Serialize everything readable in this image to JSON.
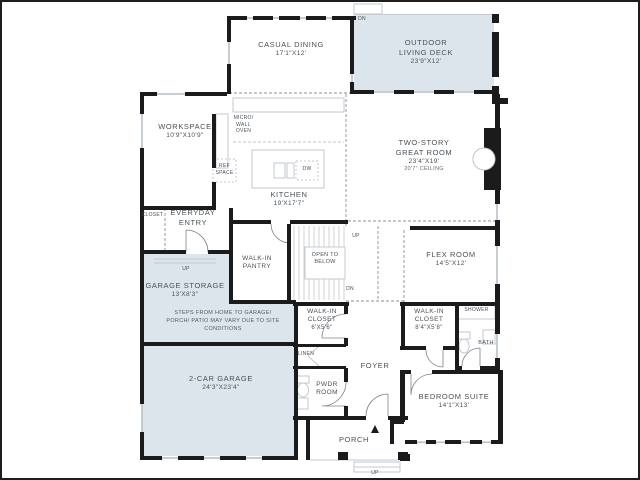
{
  "meta": {
    "shade_color": "#dce4ec",
    "wall_color": "#1b1b1b",
    "text_color": "#4b5156"
  },
  "rooms": {
    "casual_dining": {
      "name": "CASUAL DINING",
      "dims": "17'1\"X12'"
    },
    "outdoor_deck": {
      "name": "OUTDOOR LIVING DECK",
      "dims": "23'9\"X12'"
    },
    "workspace": {
      "name": "WORKSPACE",
      "dims": "10'9\"X10'9\""
    },
    "great_room": {
      "name": "TWO-STORY GREAT ROOM",
      "dims": "23'4\"X19'",
      "ceiling": "20'7\" CEILING"
    },
    "kitchen": {
      "name": "KITCHEN",
      "dims": "19'X17'7\""
    },
    "everyday_entry": {
      "name": "EVERYDAY ENTRY"
    },
    "closet": {
      "name": "CLOSET"
    },
    "walk_in_pantry": {
      "name": "WALK-IN PANTRY"
    },
    "open_to_below": {
      "name": "OPEN TO BELOW"
    },
    "flex_room": {
      "name": "FLEX ROOM",
      "dims": "14'5\"X12'"
    },
    "garage_storage": {
      "name": "GARAGE STORAGE",
      "dims": "13'X8'3\""
    },
    "garage_note": "STEPS FROM HOME TO GARAGE/ PORCH/ PATIO MAY VARY DUE TO SITE CONDITIONS",
    "walk_in_closet_a": {
      "name": "WALK-IN CLOSET",
      "dims": "6'X5'6\""
    },
    "walk_in_closet_b": {
      "name": "WALK-IN CLOSET",
      "dims": "8'4\"X5'8\""
    },
    "linen": {
      "name": "LINEN"
    },
    "pwdr_room": {
      "name": "PWDR ROOM"
    },
    "foyer": {
      "name": "FOYER"
    },
    "shower": {
      "name": "SHOWER"
    },
    "bath": {
      "name": "BATH"
    },
    "two_car_garage": {
      "name": "2-CAR GARAGE",
      "dims": "24'3\"X23'4\""
    },
    "bedroom_suite": {
      "name": "BEDROOM SUITE",
      "dims": "14'1\"X13'"
    },
    "porch": {
      "name": "PORCH"
    }
  },
  "fixtures": {
    "micro_wall_oven": "MICRO/ WALL OVEN",
    "ref_space": "REF SPACE",
    "dishwasher": "DW"
  },
  "markers": {
    "deck_dn": "DN",
    "stairs_up": "UP",
    "stairs_dn": "DN",
    "storage_up": "UP",
    "porch_up": "UP"
  }
}
